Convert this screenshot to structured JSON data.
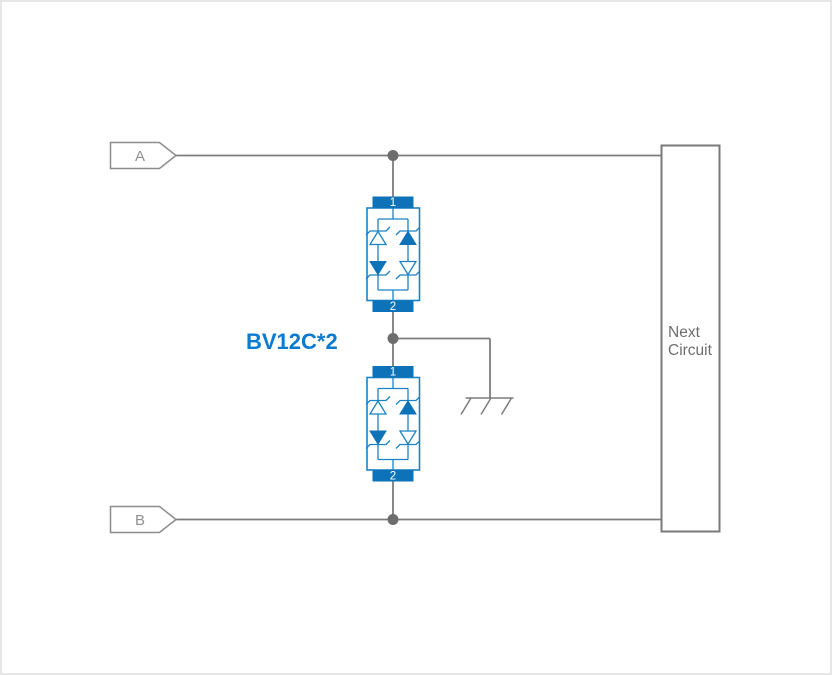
{
  "terminals": {
    "a": {
      "label": "A"
    },
    "b": {
      "label": "B"
    }
  },
  "part_label": "BV12C*2",
  "devices": [
    {
      "pin_top": "1",
      "pin_bottom": "2"
    },
    {
      "pin_top": "1",
      "pin_bottom": "2"
    }
  ],
  "next_circuit": {
    "line1": "Next",
    "line2": "Circuit"
  },
  "symbols": {
    "ground": "chassis-ground-icon",
    "device": "bidirectional-tvs-diode-array-icon"
  },
  "colors": {
    "component_blue": "#0d72b8",
    "component_outline_blue": "#1b82c8",
    "part_label_blue": "#0b7ad1",
    "wire_gray": "#7c7c7c",
    "junction_dot_gray": "#6d6d6d",
    "terminal_gray": "#8c8c8c",
    "block_text_gray": "#6e6e6e",
    "canvas_border": "#e7e7e7"
  }
}
